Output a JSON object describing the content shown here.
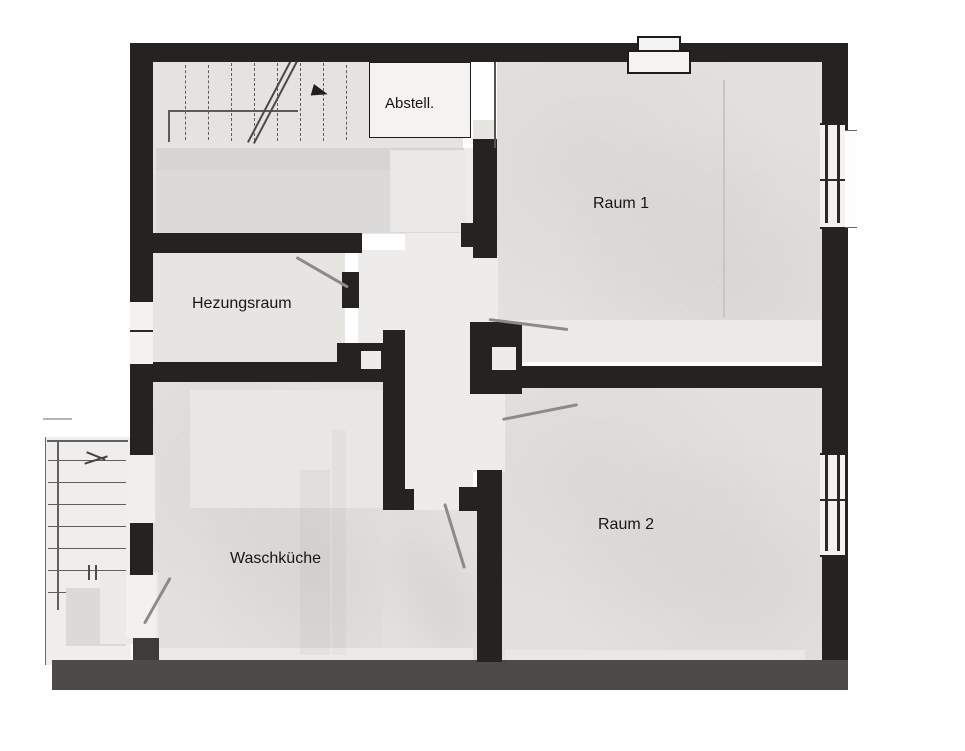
{
  "rooms": {
    "abstell": {
      "label": "Abstell."
    },
    "raum1": {
      "label": "Raum 1"
    },
    "hezungsraum": {
      "label": "Hezungsraum"
    },
    "waschkueche": {
      "label": "Waschküche"
    },
    "raum2": {
      "label": "Raum 2"
    }
  },
  "annotations": {
    "color": "#8b8b89",
    "pointer_lines": [
      {
        "x1": 297,
        "y1": 256,
        "x2": 349,
        "y2": 286
      },
      {
        "x1": 489,
        "y1": 318,
        "x2": 568,
        "y2": 328
      },
      {
        "x1": 502,
        "y1": 418,
        "x2": 578,
        "y2": 403
      },
      {
        "x1": 446,
        "y1": 503,
        "x2": 466,
        "y2": 568
      },
      {
        "x1": 143,
        "y1": 623,
        "x2": 169,
        "y2": 577
      }
    ]
  },
  "colors": {
    "wall": "#242320",
    "room_fill": "#e2e1de",
    "corridor_fill": "#edecea",
    "bottom_wall": "#4c4b49",
    "background": "#ffffff",
    "label_text": "#161616"
  }
}
